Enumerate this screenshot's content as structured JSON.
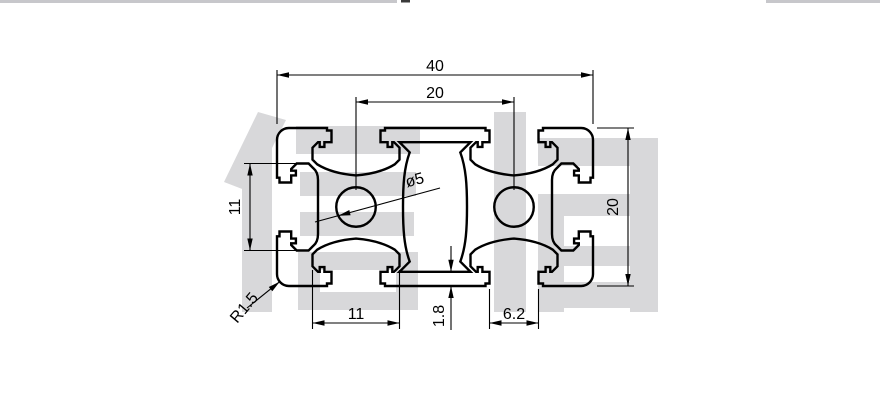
{
  "drawing": {
    "type": "aluminium-extrusion-profile-cross-section",
    "dimensions": {
      "overall_width": "40",
      "slot_pitch": "20",
      "overall_height": "20",
      "side_slot_chamber_width": "11",
      "bottom_slot_chamber_width": "11",
      "wall_thickness": "1.8",
      "slot_opening_width": "6.2",
      "center_hole_diameter": "ø5",
      "corner_radius": "R1.5"
    },
    "watermark_text": "信辉"
  }
}
